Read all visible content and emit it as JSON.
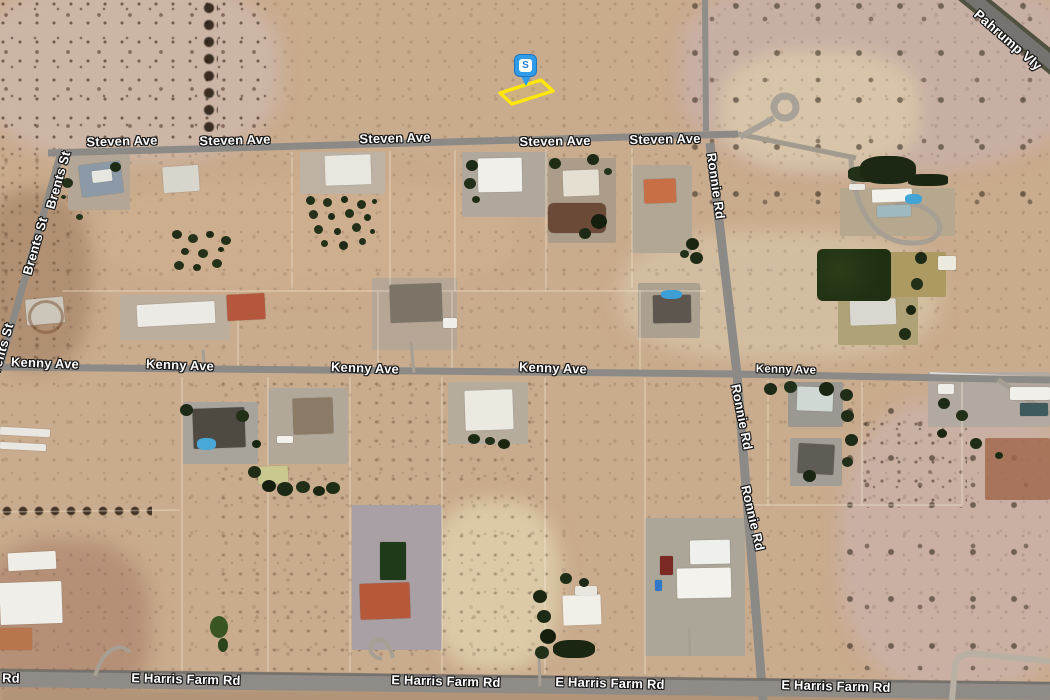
{
  "map": {
    "marker": {
      "label": "S",
      "pin_color": "#2e9be8",
      "parcel_outline_color": "#ffe70a"
    },
    "street_labels": [
      {
        "text": "Steven Ave",
        "x": 122,
        "y": 141,
        "rot": -1.5,
        "fs": 13
      },
      {
        "text": "Steven Ave",
        "x": 235,
        "y": 140,
        "rot": -1.5,
        "fs": 13
      },
      {
        "text": "Steven Ave",
        "x": 395,
        "y": 138,
        "rot": -1.5,
        "fs": 13
      },
      {
        "text": "Steven Ave",
        "x": 555,
        "y": 141,
        "rot": -1,
        "fs": 13
      },
      {
        "text": "Steven Ave",
        "x": 665,
        "y": 139,
        "rot": -1,
        "fs": 13
      },
      {
        "text": "Kenny Ave",
        "x": 45,
        "y": 363,
        "rot": 2,
        "fs": 13
      },
      {
        "text": "Kenny Ave",
        "x": 180,
        "y": 365,
        "rot": 2,
        "fs": 13
      },
      {
        "text": "Kenny Ave",
        "x": 365,
        "y": 368,
        "rot": 2,
        "fs": 13
      },
      {
        "text": "Kenny Ave",
        "x": 553,
        "y": 368,
        "rot": 2,
        "fs": 13
      },
      {
        "text": "Kenny Ave",
        "x": 786,
        "y": 370,
        "rot": 1.5,
        "fs": 11.5
      },
      {
        "text": "E Harris Farm Rd",
        "x": 186,
        "y": 679,
        "rot": 1.5,
        "fs": 13
      },
      {
        "text": "E Harris Farm Rd",
        "x": 446,
        "y": 681,
        "rot": 1.5,
        "fs": 13
      },
      {
        "text": "E Harris Farm Rd",
        "x": 610,
        "y": 683,
        "rot": 1.5,
        "fs": 13
      },
      {
        "text": "E Harris Farm Rd",
        "x": 836,
        "y": 686,
        "rot": 1.5,
        "fs": 13
      },
      {
        "text": "Rd",
        "x": 11,
        "y": 678,
        "rot": 1.5,
        "fs": 13
      },
      {
        "text": "Brents St",
        "x": 58,
        "y": 180,
        "rot": -74,
        "fs": 13
      },
      {
        "text": "Brents St",
        "x": 35,
        "y": 246,
        "rot": -74,
        "fs": 13
      },
      {
        "text": "Brents St",
        "x": 1,
        "y": 352,
        "rot": -74,
        "fs": 13
      },
      {
        "text": "Ronnie Rd",
        "x": 716,
        "y": 186,
        "rot": 82,
        "fs": 13
      },
      {
        "text": "Ronnie Rd",
        "x": 742,
        "y": 417,
        "rot": 79,
        "fs": 13
      },
      {
        "text": "Ronnie Rd",
        "x": 753,
        "y": 518,
        "rot": 77,
        "fs": 13
      },
      {
        "text": "Pahrump Vly",
        "x": 1008,
        "y": 40,
        "rot": 41,
        "fs": 13.5
      }
    ]
  },
  "palette": {
    "desert_base": "#c9ab8d",
    "road_gray": "#8b8a86",
    "highway_gray": "#757370",
    "label_text": "#ffffff"
  }
}
